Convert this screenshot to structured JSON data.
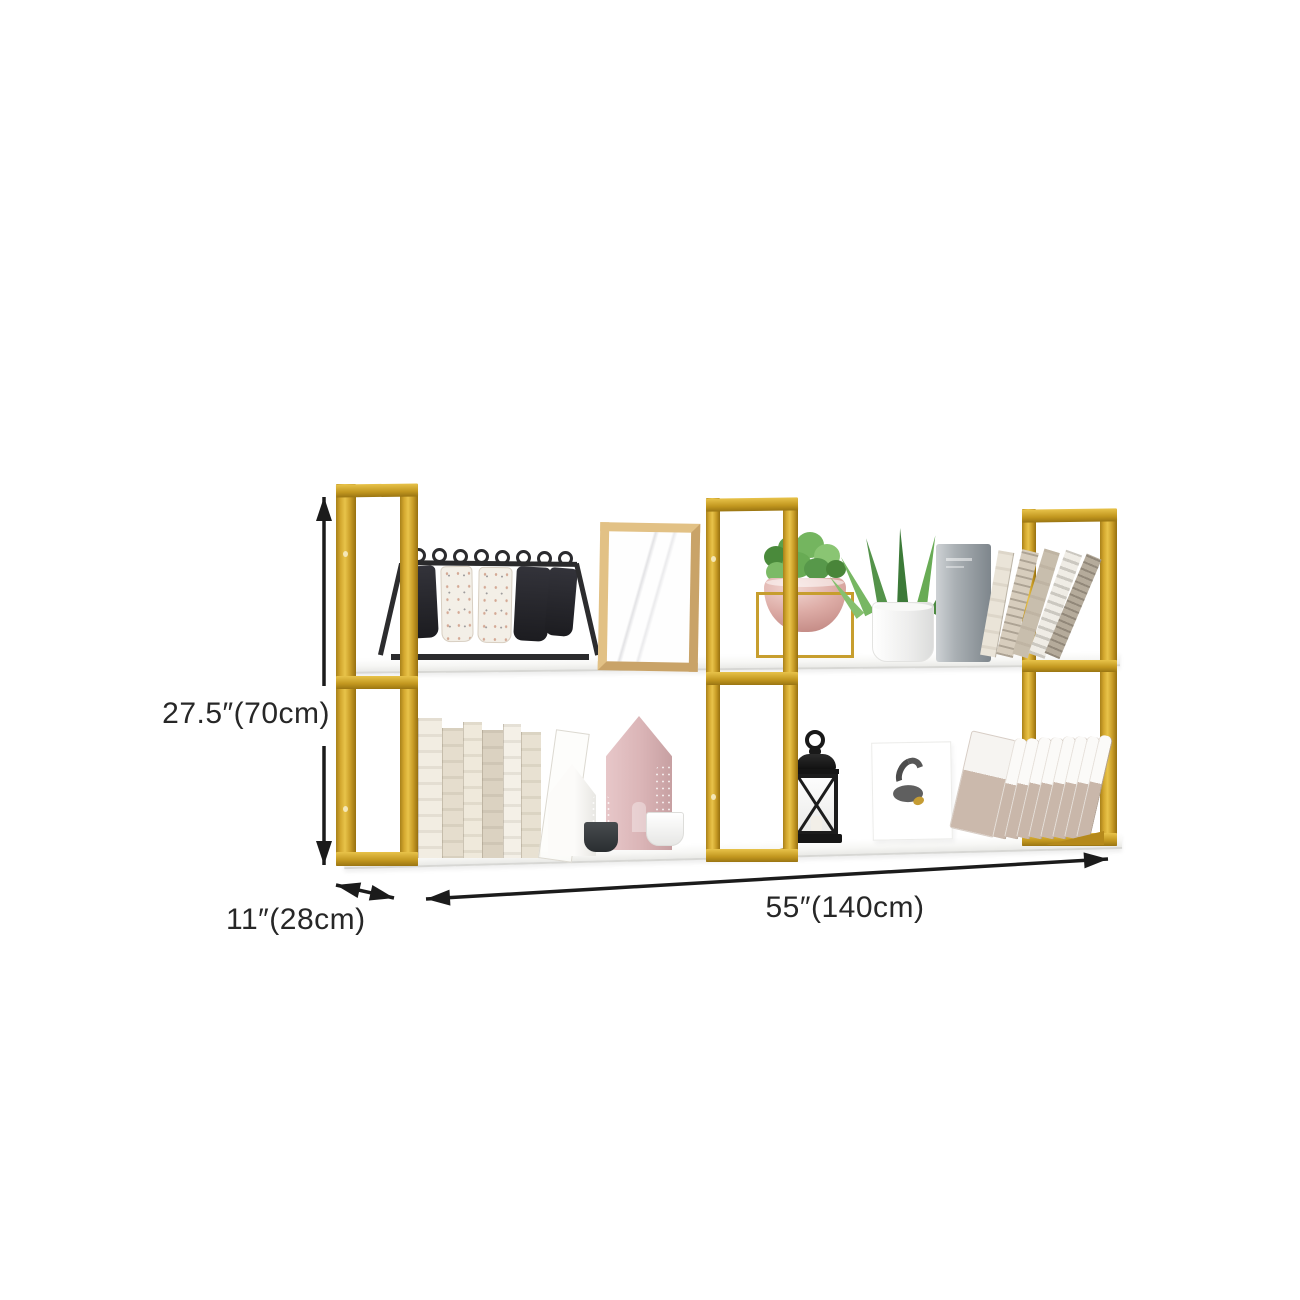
{
  "image": {
    "description": "Two-tier wall mounted shelf with gold metal frames and white boards, styled with decor objects, annotated with product dimensions",
    "background_color": "#ffffff"
  },
  "dimensions": {
    "height": {
      "label": "27.5″(70cm)",
      "inches": "27.5",
      "centimeters": "70"
    },
    "depth": {
      "label": "11″(28cm)",
      "inches": "11",
      "centimeters": "28"
    },
    "width": {
      "label": "55″(140cm)",
      "inches": "55",
      "centimeters": "140"
    }
  },
  "colors": {
    "frame_gold": "#cf9f2a",
    "frame_gold_highlight": "#e8c34a",
    "frame_gold_shadow": "#97700f",
    "shelf_white": "#fafaf8",
    "arrow": "#1b1b1b",
    "label_text": "#272727",
    "decor_pink": "#dcb0ad",
    "decor_green": "#5c9045"
  },
  "decor": {
    "top_shelf_items": [
      "flip-card-display-stand",
      "wooden-picture-frame",
      "pink-bowl-planter-in-gold-wire-stand",
      "white-pot-green-plant",
      "gray-book",
      "leaning-magazines"
    ],
    "bottom_shelf_items": [
      "standing-books",
      "clear-leaning-bookend",
      "white-house-figurine",
      "pink-house-figurine",
      "cactus-in-black-pot",
      "cactus-in-white-pot",
      "black-candle-lantern",
      "abstract-art-print",
      "leaning-files"
    ]
  }
}
